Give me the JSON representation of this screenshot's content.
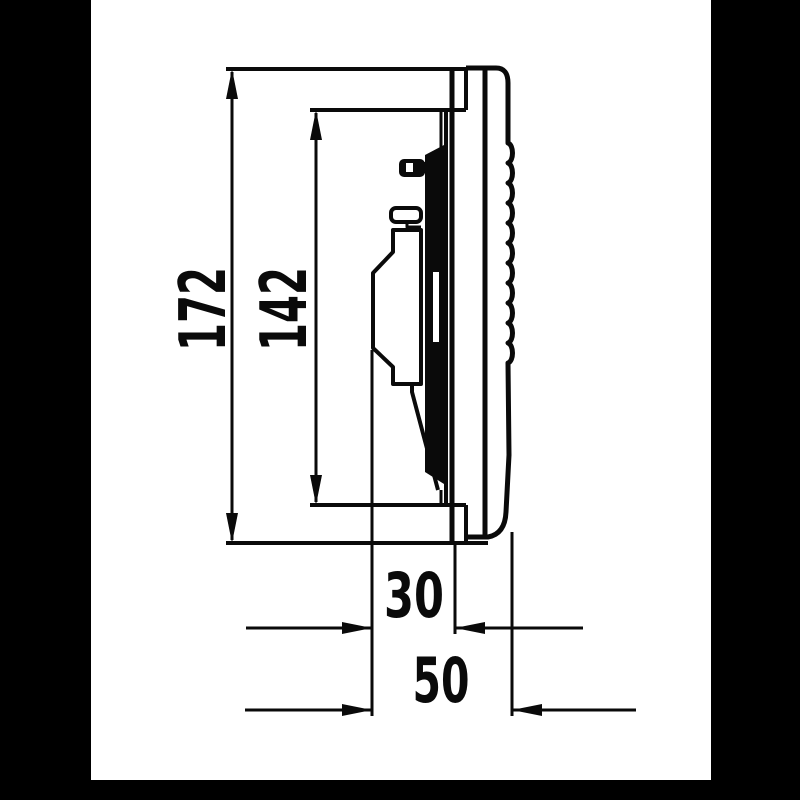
{
  "drawing": {
    "title": "loudspeaker-side-view-dimension-drawing",
    "view": "side-profile",
    "colors": {
      "paper": "#ffffff",
      "ink": "#0a0a0a",
      "letterbox": "#000000"
    },
    "dimensions": {
      "height_overall": "172",
      "height_inner": "142",
      "depth_recess": "30",
      "depth_overall": "50"
    }
  }
}
